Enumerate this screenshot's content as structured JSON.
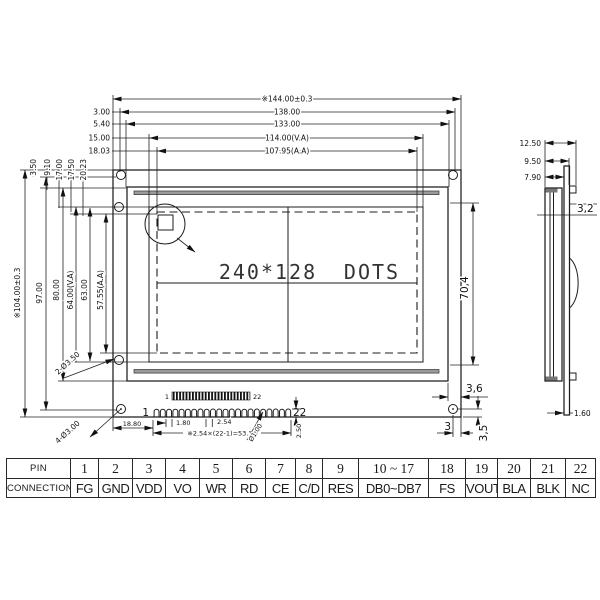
{
  "front_view": {
    "display_left": "240*128",
    "display_right": "DOTS",
    "dims_top": [
      "※144.00±0.3",
      "138.00",
      "133.00",
      "114.00(V.A)",
      "107.95(A.A)"
    ],
    "offsets_top": [
      "3.00",
      "5.40",
      "15.00",
      "18.03"
    ],
    "dims_left": [
      "※104.00±0.3",
      "97.00",
      "80.00",
      "64.00(V.A)",
      "63.00",
      "57.55(A.A)"
    ],
    "offsets_left": [
      "3.50",
      "9.10",
      "17.00",
      "17.50",
      "20.23"
    ],
    "hole_side_label": "2-Ø3.50",
    "hole_corner_label": "4-Ø3.00",
    "dim_va_height": "70,4",
    "dim_gap": "3,6",
    "dim_hole_x": "3",
    "dim_hole_y": "3,5"
  },
  "connector": {
    "first_pin": "1",
    "last_pin": "22",
    "strip_first": "1",
    "strip_last": "22",
    "dim_offset": "18.80",
    "dim_pin_width": "1.80",
    "dim_pitch": "2.54",
    "dim_total": "※2.54×(22-1)=53.34",
    "dim_pin_dia": "Ø1.00",
    "dim_pin_height": "2.50"
  },
  "side_view": {
    "dim_total_thickness": "12.50",
    "dim_mid": "9.50",
    "dim_front": "7.90",
    "dim_step": "3,2",
    "dim_pcb": "1.60"
  },
  "pin_table": {
    "row1_label": "PIN",
    "row2_label": "CONNECTION",
    "pins": [
      "1",
      "2",
      "3",
      "4",
      "5",
      "6",
      "7",
      "8",
      "9",
      "10 ~ 17",
      "18",
      "19",
      "20",
      "21",
      "22"
    ],
    "connections": [
      "FG",
      "GND",
      "VDD",
      "VO",
      "WR",
      "RD",
      "CE",
      "C/D",
      "RES",
      "DB0~DB7",
      "FS",
      "VOUT",
      "BLA",
      "BLK",
      "NC"
    ]
  }
}
